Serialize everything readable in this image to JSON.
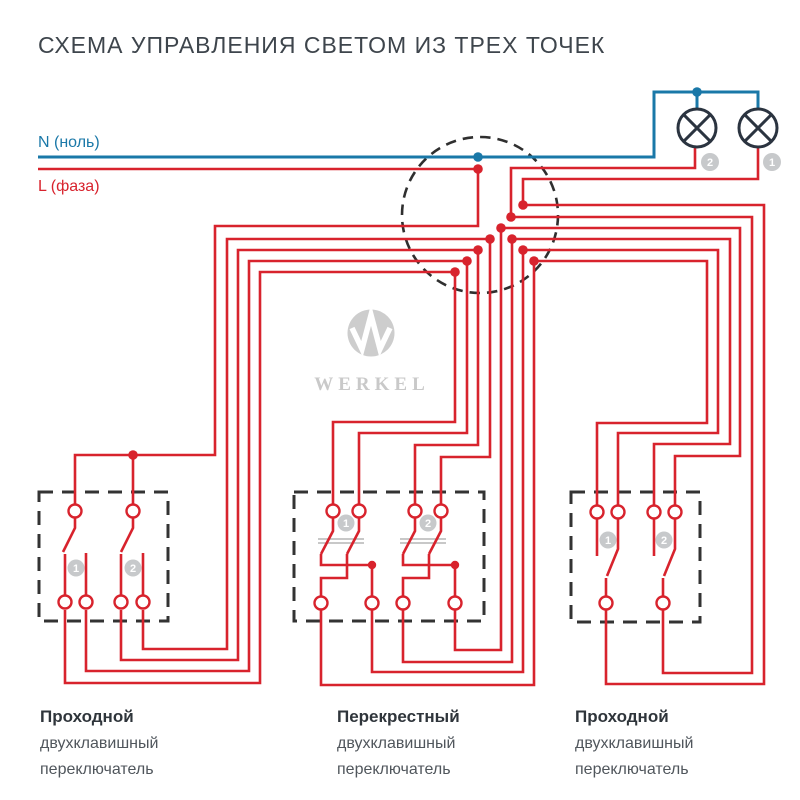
{
  "title": "СХЕМА УПРАВЛЕНИЯ СВЕТОМ ИЗ ТРЕХ ТОЧЕК",
  "wiring": {
    "neutral_label": "N (ноль)",
    "phase_label": "L (фаза)"
  },
  "colors": {
    "neutral_blue": "#1a78a8",
    "phase_red": "#d8232d",
    "lamp_outline": "#2b3440",
    "enclosure_dash": "#333333",
    "badge_gray": "#c7c9cb",
    "watermark_gray": "#cdcdcd",
    "title_text": "#3e454c",
    "label_text": "#50565c"
  },
  "lamps": {
    "lamp_1_badge": "1",
    "lamp_2_badge": "2"
  },
  "watermark": {
    "brand": "WERKEL"
  },
  "switches": {
    "left": {
      "gang_badges": [
        "1",
        "2"
      ],
      "label": [
        "Проходной",
        "двухклавишный",
        "переключатель"
      ]
    },
    "middle": {
      "gang_badges": [
        "1",
        "2"
      ],
      "label": [
        "Перекрестный",
        "двухклавишный",
        "переключатель"
      ]
    },
    "right": {
      "gang_badges": [
        "1",
        "2"
      ],
      "label": [
        "Проходной",
        "двухклавишный",
        "переключатель"
      ]
    }
  }
}
